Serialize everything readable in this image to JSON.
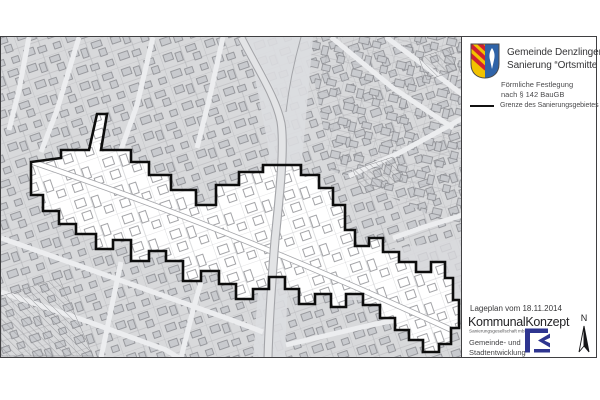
{
  "legend": {
    "title_line1": "Gemeinde Denzlingen",
    "title_line2": "Sanierung “Ortsmitte II”",
    "subtitle_line1": "Förmliche Festlegung",
    "subtitle_line2": "nach § 142 BauGB",
    "boundary_label": "Grenze des Sanierungsgebietes"
  },
  "footer": {
    "date_label": "Lageplan vom 18.11.2014",
    "company": "KommunalKonzept",
    "company_sub": "Sanierungsgesellschaft mbH",
    "dept_line1": "Gemeinde- und",
    "dept_line2": "Stadtentwicklung",
    "north_label": "N"
  },
  "icons": {
    "coat_of_arms": "denzlingen-coat-of-arms-icon",
    "company_logo": "kommunalkonzept-logo-icon",
    "north_arrow": "north-arrow-icon",
    "boundary_swatch": "boundary-line-swatch"
  },
  "colors": {
    "boundary": "#0d0d0d",
    "map_background": "#d8d9db",
    "sanierung_area": "#ffffff",
    "shield_gold": "#f2c200",
    "shield_red": "#cf2030",
    "shield_blue": "#2f63a8",
    "logo_navy": "#2e3590"
  },
  "map": {
    "type": "cadastral-plan",
    "highlighted_area": "Sanierungsgebiet Ortsmitte II"
  }
}
